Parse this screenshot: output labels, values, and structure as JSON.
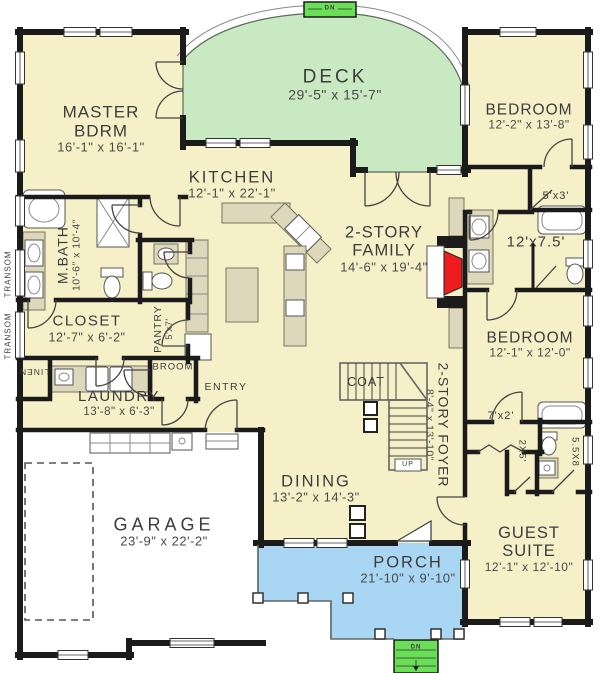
{
  "colors": {
    "floor": "#f6f0c8",
    "deck": "#c9e9c3",
    "porch": "#a9d6f3",
    "steps": "#6ade57",
    "wall": "#1b1b1b",
    "fixture": "#ddd8bc",
    "fireplace": "#ee1c1c",
    "garage": "#ffffff",
    "text": "#3c3c3c"
  },
  "rooms": {
    "master": {
      "l1": "MASTER",
      "l2": "BDRM",
      "dims": "16'-1\" x 16'-1\""
    },
    "deck": {
      "l1": "DECK",
      "dims": "29'-5\" x 15'-7\""
    },
    "kitchen": {
      "l1": "KITCHEN",
      "dims": "12'-1\" x 22'-1\""
    },
    "family": {
      "l1": "2-STORY",
      "l2": "FAMILY",
      "dims": "14'-6\" x 19'-4\""
    },
    "bedroom_top": {
      "l1": "BEDROOM",
      "dims": "12'-2\" x 13'-8\""
    },
    "closet_5x3": {
      "l1": "5'x3'"
    },
    "bath_shared": {
      "l1": "12'x7.5'"
    },
    "mbath": {
      "l1": "M.BATH",
      "dims": "10'-6\" x 10'-4\""
    },
    "closet_master": {
      "l1": "CLOSET",
      "dims": "12'-7\" x 6'-2\""
    },
    "pantry": {
      "l1": "PANTRY",
      "dims": "5'x7'"
    },
    "bedroom_mid": {
      "l1": "BEDROOM",
      "dims": "12'-1\" x 12'-0\""
    },
    "laundry": {
      "l1": "LAUNDRY",
      "dims": "13'-8\" x 6'-3\""
    },
    "linen": {
      "l1": "LINEN"
    },
    "broom": {
      "l1": "BROOM"
    },
    "entry": {
      "l1": "ENTRY"
    },
    "coat": {
      "l1": "COAT"
    },
    "closet_7x2": {
      "l1": "7'x2'"
    },
    "closet_2x5": {
      "l1": "2X5'"
    },
    "bath_guest": {
      "l1": "5.5X8"
    },
    "foyer": {
      "l1": "2-STORY FOYER",
      "dims": "8'-4\" x 13'-10\""
    },
    "dining": {
      "l1": "DINING",
      "dims": "13'-2\" x 14'-3\""
    },
    "garage": {
      "l1": "GARAGE",
      "dims": "23'-9\" x 22'-2\""
    },
    "guest": {
      "l1": "GUEST",
      "l2": "SUITE",
      "dims": "12'-1\" x 12'-10\""
    },
    "porch": {
      "l1": "PORCH",
      "dims": "21'-10\" x 9'-10\""
    }
  },
  "annotations": {
    "transom": "TRANSOM",
    "dn": "DN",
    "up": "UP"
  }
}
